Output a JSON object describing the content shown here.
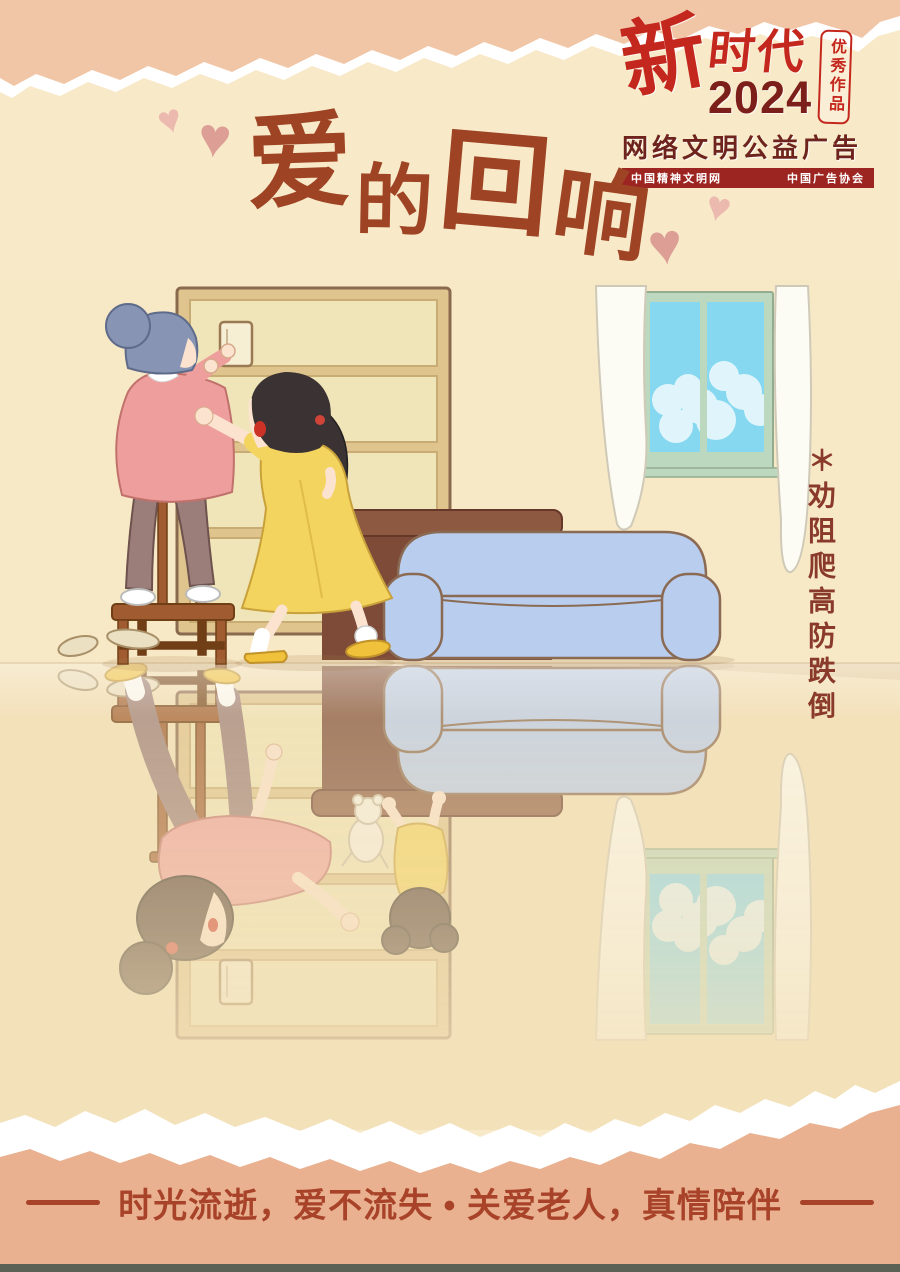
{
  "poster": {
    "badge": {
      "brand_calligraphy": "新",
      "brand_rest": "时代",
      "year": "2024",
      "seal_text": "优秀作品",
      "subtitle": "网络文明公益广告",
      "banner_left": "中国精神文明网",
      "banner_right": "中国广告协会"
    },
    "title": {
      "chars": [
        "爱",
        "的",
        "回",
        "响"
      ]
    },
    "side_note": "＊劝阻爬高防跌倒",
    "tagline": "时光流逝，爱不流失 • 关爱老人，真情陪伴",
    "decor": {
      "heart_glyph": "♥"
    },
    "palette": {
      "bg_cream": "#f8eac9",
      "wall": "#f8e9c6",
      "floor": "#f3e1ba",
      "salmon_top": "#f1c6a7",
      "salmon_bottom": "#e9b190",
      "bar_dark": "#5c6155",
      "title_brown": "#9e4425",
      "logo_red": "#c4271d",
      "logo_maroon": "#7c1f1b",
      "subtitle_maroon": "#6e241c",
      "banner_bg": "#9d2521",
      "banner_text": "#ffffff",
      "heart_light": "#ecb9ae",
      "heart_dark": "#dd9e95",
      "note_brown": "#8a3a2a",
      "tagline_red": "#a8432a",
      "shelf_frame": "#dfc48e",
      "shelf_panel": "#f0e5b8",
      "shelf_outline": "#8a6a4e",
      "window_green": "#bcd8be",
      "sky_blue": "#85d8f0",
      "curtain_white": "#fdfcf4",
      "table_brown": "#7d4b38",
      "table_top": "#8d5a41",
      "sofa_blue": "#b9cdee",
      "sofa_outline": "#8a6a52",
      "stool_brown": "#a05c30",
      "stool_dark": "#713f16",
      "skin": "#fbe3cf",
      "granny_hair": "#8794b3",
      "sweater_pink": "#ee9f9d",
      "pants_mauve": "#9b7d79",
      "daughter_hair": "#3a3233",
      "dress_yellow": "#f3d45e",
      "slipper_yellow": "#f0c23c",
      "mother_hair": "#523c32",
      "teddy_white": "#f7f2e6"
    }
  }
}
